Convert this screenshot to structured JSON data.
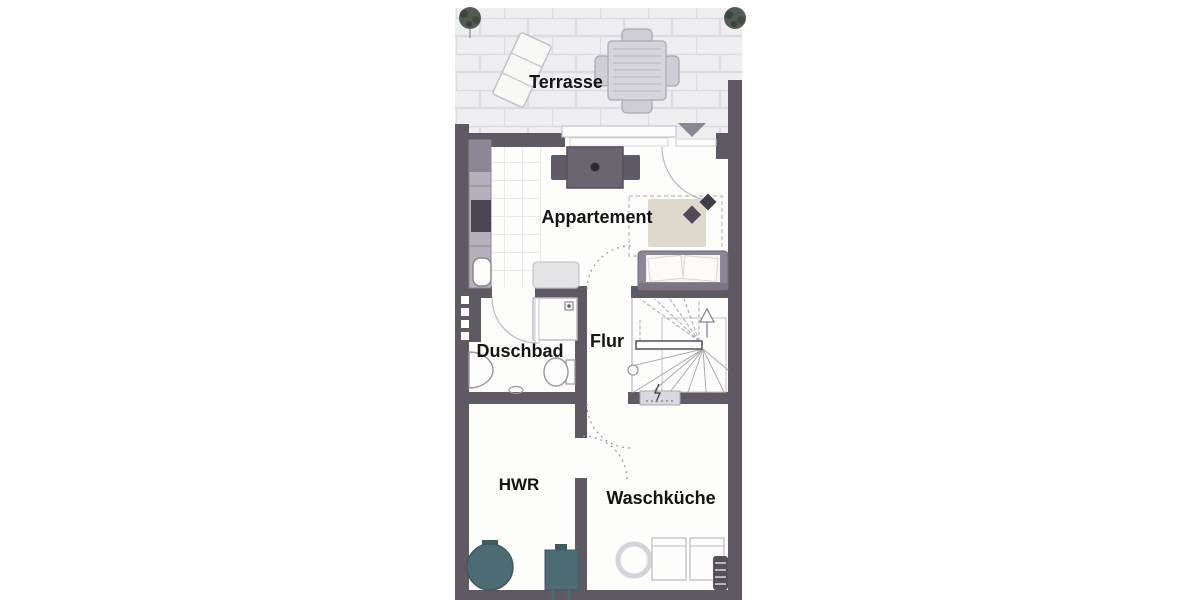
{
  "floorplan": {
    "labels": {
      "terrasse": "Terrasse",
      "appartement": "Appartement",
      "duschbad": "Duschbad",
      "flur": "Flur",
      "hwr": "HWR",
      "waschkueche": "Waschküche"
    },
    "colors": {
      "wall": "#5e5963",
      "paving": "#eeedf0",
      "grout": "#dcdbe0",
      "floor": "#fdfdfc",
      "appliance_teal": "#4d6b73",
      "rug": "#ded9cd",
      "furniture_gray": "#8b8794",
      "outline_gray": "#c9c8cf",
      "label_text": "#141414"
    }
  }
}
